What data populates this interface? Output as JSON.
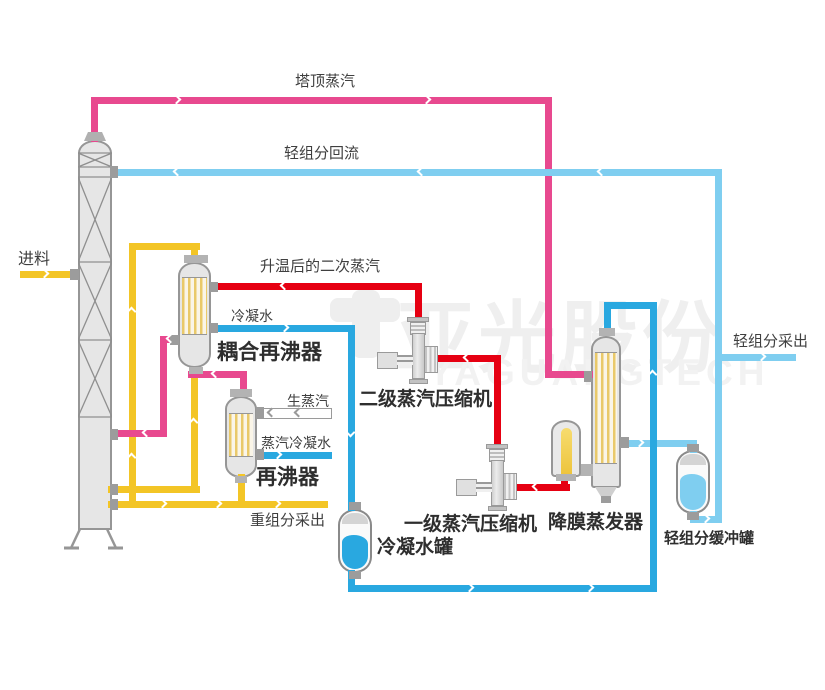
{
  "colors": {
    "magenta": "#e8498f",
    "red": "#e60012",
    "dark_blue": "#29a8e0",
    "light_blue": "#7fcef0",
    "yellow": "#f3c526",
    "pipe_gray": "#9a9a9a",
    "equipment_gray": "#e6e6e6",
    "condensate_liquid": "#29a8e0",
    "buffer_liquid": "#7fcef0"
  },
  "streams": {
    "top_steam": "塔顶蒸汽",
    "light_reflux": "轻组分回流",
    "feed": "进料",
    "heated_secondary_steam": "升温后的二次蒸汽",
    "condensate": "冷凝水",
    "raw_steam": "生蒸汽",
    "steam_condensate": "蒸汽冷凝水",
    "heavy_draw": "重组分采出",
    "light_draw": "轻组分采出"
  },
  "equipment": {
    "coupled_reboiler": "耦合再沸器",
    "reboiler": "再沸器",
    "secondary_compressor": "二级蒸汽压缩机",
    "primary_compressor": "一级蒸汽压缩机",
    "falling_film_evaporator": "降膜蒸发器",
    "condensate_tank": "冷凝水罐",
    "light_buffer_tank": "轻组分缓冲罐"
  },
  "watermark": {
    "cn": "亚光股份",
    "en": "YAGUANGTECH"
  }
}
